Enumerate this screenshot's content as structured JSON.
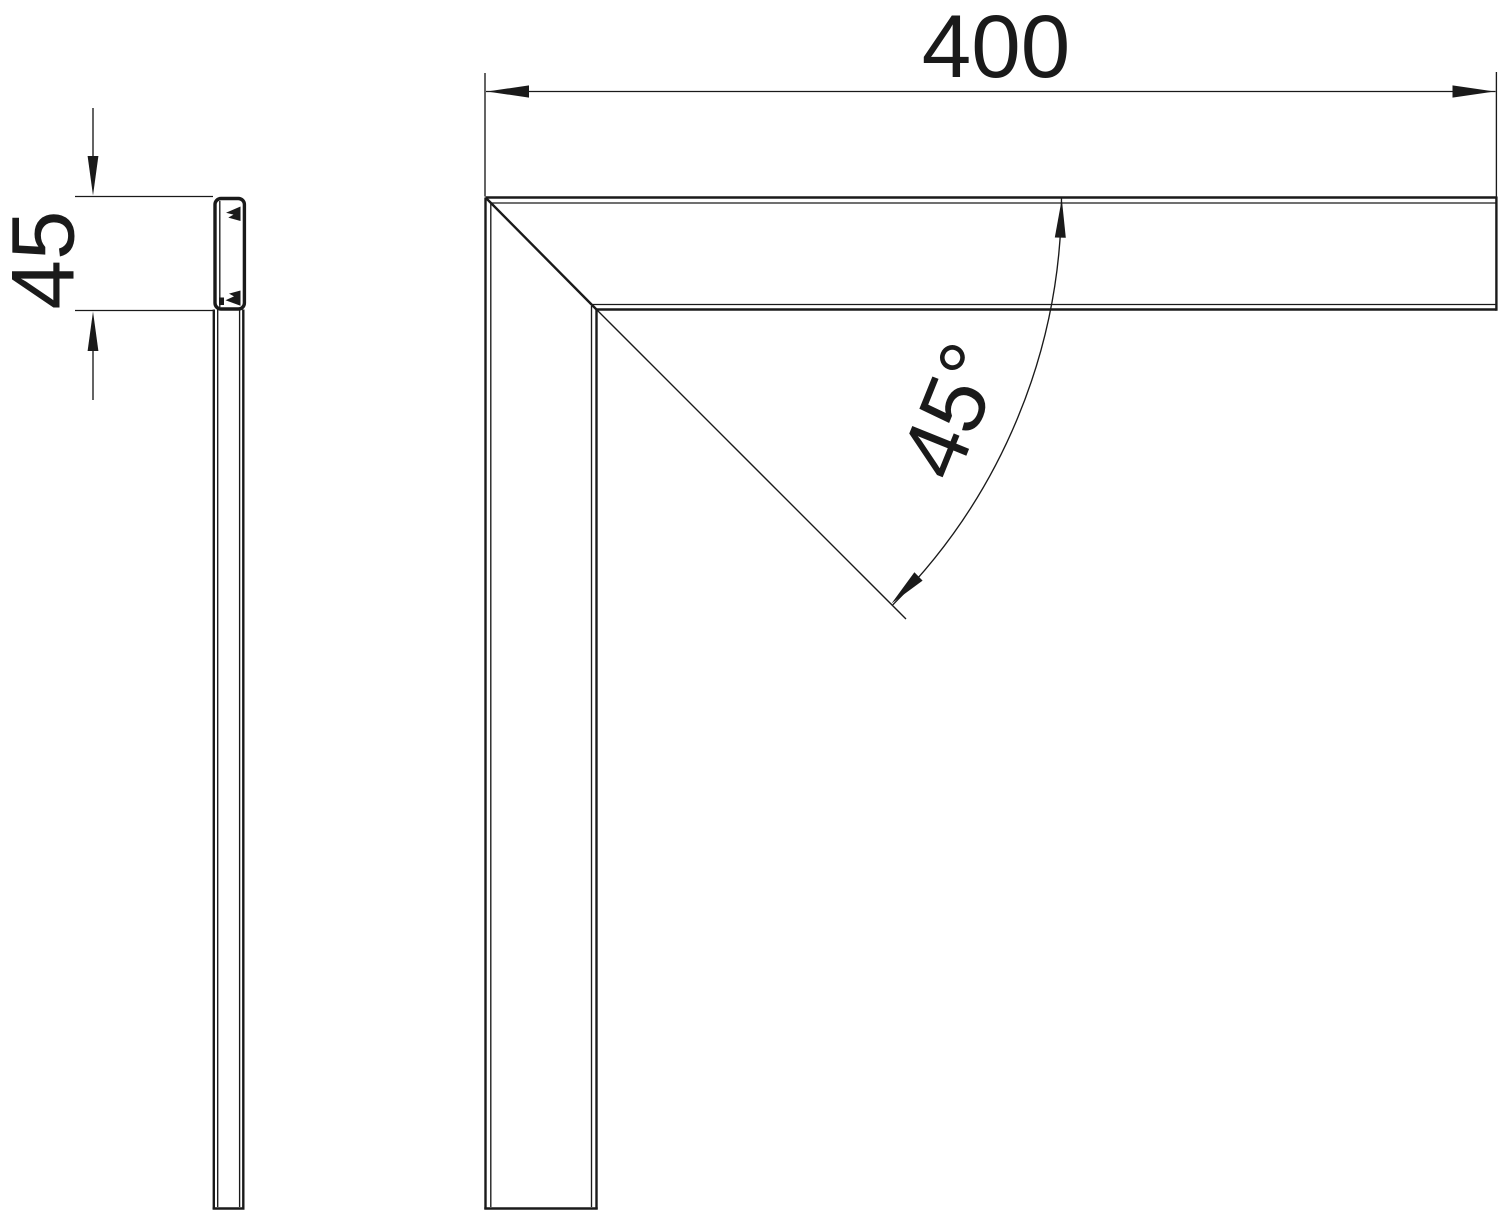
{
  "labels": {
    "width": "400",
    "height": "45",
    "angle": "45°"
  },
  "colors": {
    "line": "#1a1a1a",
    "background": "#ffffff"
  }
}
